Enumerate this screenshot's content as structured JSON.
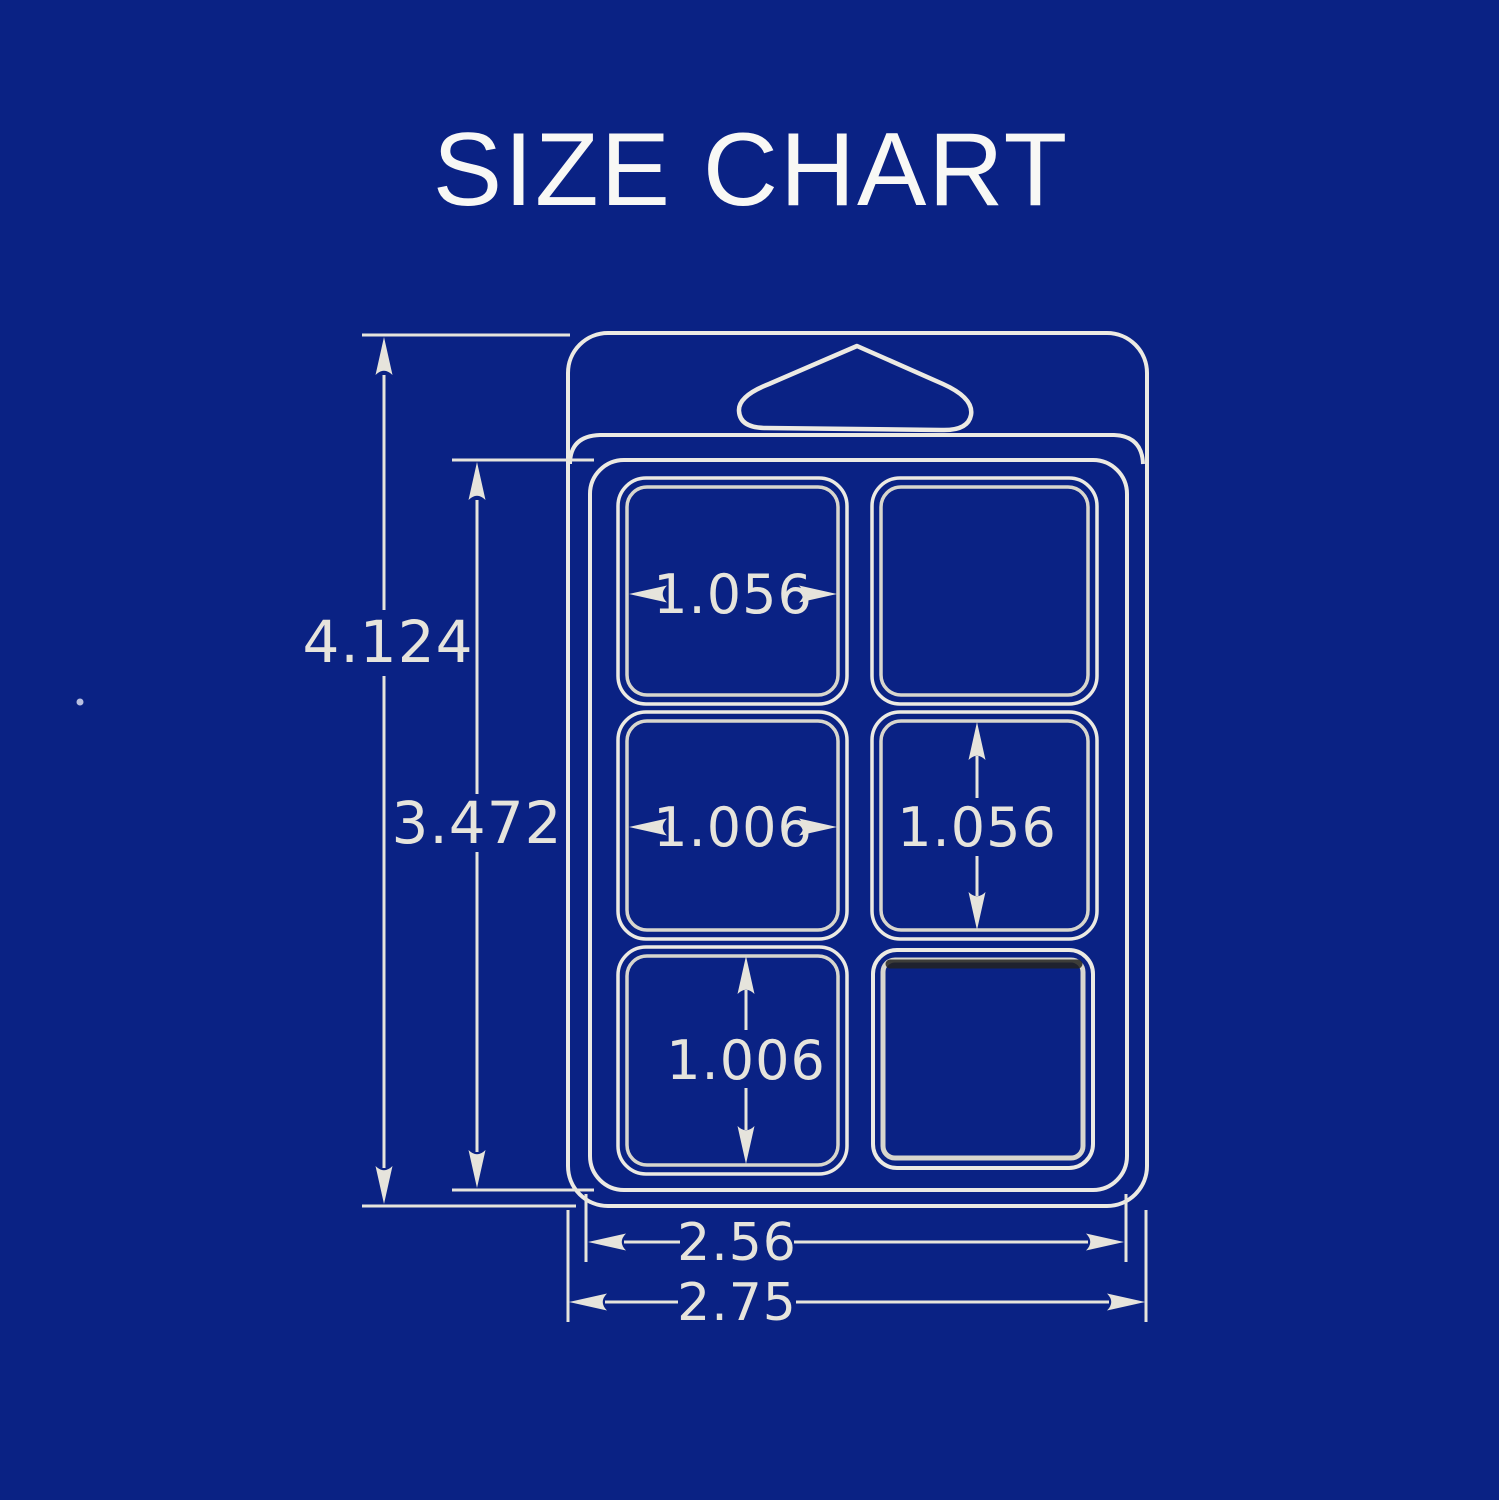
{
  "title": "SIZE CHART",
  "colors": {
    "background": "#0a2284",
    "line": "#eceae3",
    "line_dim": "#e6e4dc",
    "cavity_inner": "#d8d6cd",
    "dark_edge": "#232320",
    "title_text": "#f8f8f5"
  },
  "labels": {
    "overall_height": "4.124",
    "tray_height": "3.472",
    "cavity_width_top": "1.056",
    "cavity_width_middle": "1.006",
    "cavity_height_middle": "1.056",
    "cavity_height_bottom": "1.006",
    "tray_width": "2.56",
    "overall_width": "2.75"
  }
}
